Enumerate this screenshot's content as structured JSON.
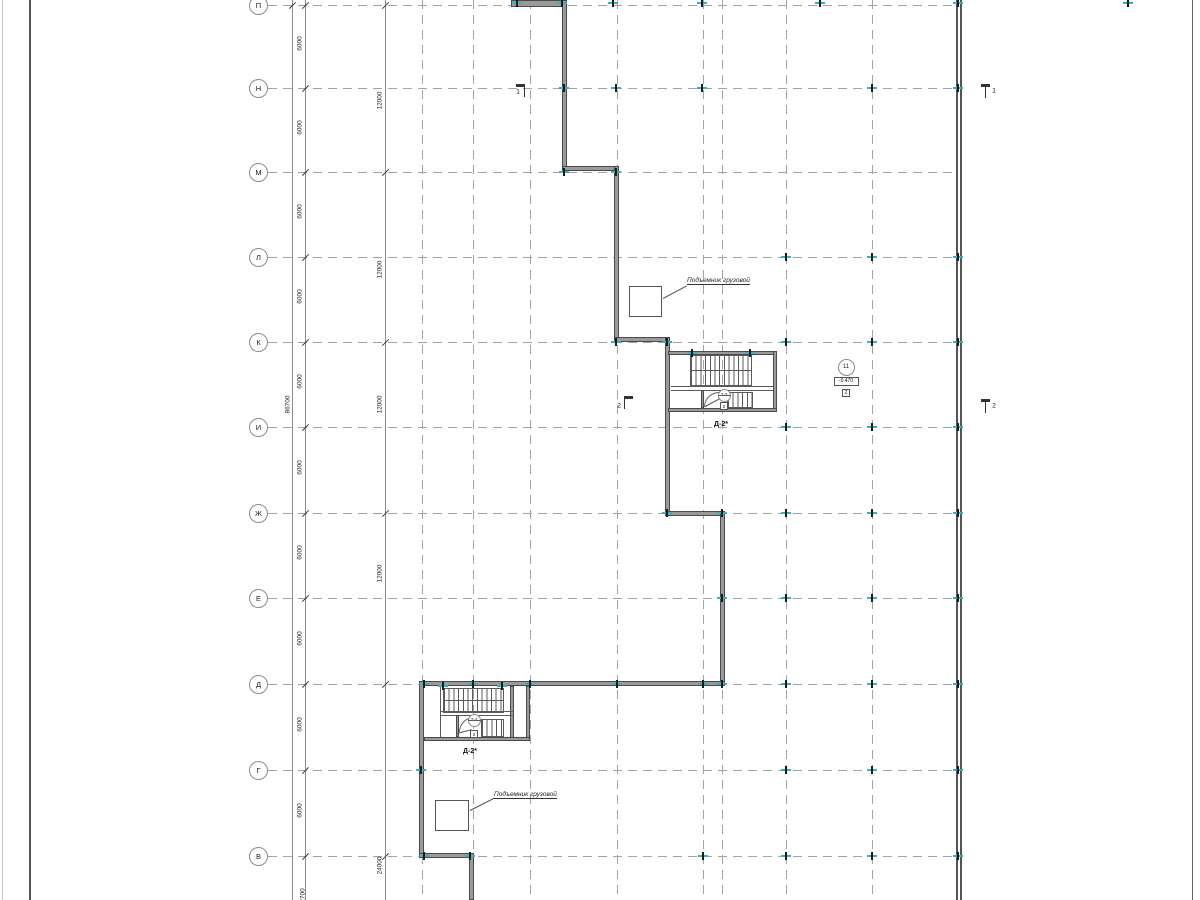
{
  "colors": {
    "accent_teal": "#2fb5bd",
    "wall_fill": "#9a9a9a",
    "wall_edge": "#4b4b4b",
    "grid_gray": "#a3a3a3",
    "chain_gray": "#8c8c8c"
  },
  "frame": {
    "lines": [
      {
        "x": 2,
        "w": 1,
        "color": "#c9c9c9"
      },
      {
        "x": 29,
        "w": 2,
        "color": "#555555"
      },
      {
        "x": 1192,
        "w": 1,
        "color": "#666666"
      }
    ],
    "boundary_double": [
      956,
      960
    ]
  },
  "axis_rows": [
    {
      "label": "П",
      "y": 5
    },
    {
      "label": "Н",
      "y": 88
    },
    {
      "label": "М",
      "y": 172
    },
    {
      "label": "Л",
      "y": 257
    },
    {
      "label": "К",
      "y": 342
    },
    {
      "label": "И",
      "y": 427
    },
    {
      "label": "Ж",
      "y": 513
    },
    {
      "label": "Е",
      "y": 598
    },
    {
      "label": "Д",
      "y": 684
    },
    {
      "label": "Г",
      "y": 770
    },
    {
      "label": "В",
      "y": 856
    }
  ],
  "row_line": {
    "x1": 268,
    "x2": 958
  },
  "axis_cols_x": [
    422,
    473,
    530,
    617,
    703,
    722,
    786,
    872
  ],
  "chains_x": [
    292,
    305,
    385
  ],
  "dimensions": {
    "total": {
      "text": "86700",
      "x": 288,
      "y": 407
    },
    "bays_x": 300,
    "bays": [
      {
        "text": "6000",
        "y": 46
      },
      {
        "text": "6000",
        "y": 130
      },
      {
        "text": "6000",
        "y": 214
      },
      {
        "text": "6000",
        "y": 299
      },
      {
        "text": "6000",
        "y": 384
      },
      {
        "text": "6000",
        "y": 470
      },
      {
        "text": "6000",
        "y": 555
      },
      {
        "text": "6000",
        "y": 641
      },
      {
        "text": "6000",
        "y": 727
      },
      {
        "text": "6000",
        "y": 813
      }
    ],
    "outer_x": 380,
    "outer": [
      {
        "text": "12000",
        "y": 103
      },
      {
        "text": "12000",
        "y": 272
      },
      {
        "text": "12000",
        "y": 407
      },
      {
        "text": "12000",
        "y": 576
      },
      {
        "text": "24000",
        "y": 868
      }
    ],
    "partial_bottom": {
      "text": "2700",
      "x": 303,
      "y": 898
    },
    "ticks": [
      {
        "x": 292,
        "ys": [
          5
        ]
      },
      {
        "x": 305,
        "ys": [
          5,
          88,
          172,
          257,
          342,
          427,
          513,
          598,
          684,
          770,
          856
        ]
      },
      {
        "x": 385,
        "ys": [
          5,
          172,
          342,
          513,
          684,
          856
        ]
      }
    ]
  },
  "walls": [
    [
      511,
      0,
      56,
      7
    ],
    [
      562,
      0,
      5,
      171
    ],
    [
      562,
      166,
      57,
      5
    ],
    [
      614,
      166,
      5,
      176
    ],
    [
      614,
      337,
      56,
      5
    ],
    [
      665,
      337,
      5,
      179
    ],
    [
      665,
      511,
      60,
      5
    ],
    [
      720,
      511,
      5,
      175
    ],
    [
      419,
      681,
      306,
      5
    ],
    [
      419,
      681,
      5,
      177
    ],
    [
      419,
      853,
      55,
      5
    ],
    [
      469,
      853,
      5,
      47
    ],
    [
      668,
      351,
      109,
      4
    ],
    [
      773,
      351,
      4,
      61
    ],
    [
      668,
      408,
      109,
      4
    ],
    [
      510,
      686,
      4,
      55
    ],
    [
      526,
      686,
      4,
      55
    ],
    [
      424,
      737,
      106,
      4
    ]
  ],
  "stairs": [
    {
      "tag": "Д-2*",
      "room": "7-3",
      "door_tag": "2",
      "treads1": [
        690,
        355,
        62,
        31
      ],
      "mid1": [
        690,
        370,
        62,
        1
      ],
      "landing": [
        [
          671,
          386,
          102,
          1
        ],
        [
          671,
          390,
          102,
          1
        ]
      ],
      "treads2": [
        727,
        392,
        26,
        16
      ],
      "inner_wall": [
        701,
        390,
        3,
        18
      ],
      "arc": [
        704,
        392,
        15,
        15
      ],
      "leader": {
        "x": 705,
        "y": 406,
        "len": 17,
        "ang": -28
      },
      "circle": {
        "x": 724,
        "y": 395
      },
      "box": {
        "x": 724,
        "y": 406
      },
      "label": {
        "x": 721,
        "y": 421
      }
    },
    {
      "tag": "Д-2*",
      "room": "7-4",
      "door_tag": "2",
      "treads1": [
        443,
        688,
        61,
        25
      ],
      "mid1": [
        443,
        700,
        61,
        1
      ],
      "landing": [
        [
          441,
          711,
          73,
          1
        ],
        [
          441,
          715,
          73,
          1
        ]
      ],
      "treads2": [
        481,
        719,
        23,
        18
      ],
      "inner_wall": [
        456,
        715,
        3,
        22
      ],
      "arc": [
        459,
        717,
        15,
        15
      ],
      "leader": {
        "x": 457,
        "y": 733,
        "len": 15,
        "ang": -15
      },
      "circle": {
        "x": 474,
        "y": 720
      },
      "box": {
        "x": 474,
        "y": 734
      },
      "label": {
        "x": 470,
        "y": 748
      },
      "extra_line": [
        440,
        686,
        1,
        51
      ]
    }
  ],
  "lifts": [
    {
      "label": "Подъемник грузовой",
      "square": [
        629,
        286,
        33,
        31
      ],
      "leader": {
        "x": 663,
        "y": 298,
        "len": 27,
        "ang": -28
      },
      "label_pos": {
        "x": 687,
        "y": 277
      }
    },
    {
      "label": "Подъемник грузовой",
      "square": [
        435,
        800,
        34,
        31
      ],
      "leader": {
        "x": 470,
        "y": 810,
        "len": 27,
        "ang": -27
      },
      "label_pos": {
        "x": 494,
        "y": 791
      }
    }
  ],
  "callout": {
    "circle_text": "11",
    "circle": {
      "x": 846,
      "y": 367
    },
    "level_text": "-0.470",
    "level": {
      "x": 846,
      "y": 381
    },
    "box_text": "2",
    "box": {
      "x": 846,
      "y": 393
    }
  },
  "sections": [
    {
      "label": "1",
      "bar": [
        516,
        84,
        9,
        3
      ],
      "stem": [
        524,
        84,
        1,
        13
      ],
      "lx": 518,
      "ly": 92
    },
    {
      "label": "1",
      "bar": [
        981,
        84,
        9,
        3
      ],
      "stem": [
        985,
        84,
        1,
        14
      ],
      "lx": 994,
      "ly": 91
    },
    {
      "label": "2",
      "bar": [
        624,
        396,
        9,
        3
      ],
      "stem": [
        624,
        396,
        1,
        13
      ],
      "lx": 619,
      "ly": 406
    },
    {
      "label": "2",
      "bar": [
        981,
        399,
        9,
        3
      ],
      "stem": [
        985,
        399,
        1,
        14
      ],
      "lx": 994,
      "ly": 406
    }
  ],
  "column_markers": [
    [
      517,
      3
    ],
    [
      562,
      3
    ],
    [
      613,
      3
    ],
    [
      702,
      3
    ],
    [
      820,
      3
    ],
    [
      958,
      3
    ],
    [
      1128,
      3
    ],
    [
      564,
      88
    ],
    [
      616,
      88
    ],
    [
      702,
      88
    ],
    [
      872,
      88
    ],
    [
      958,
      88
    ],
    [
      564,
      172
    ],
    [
      616,
      172
    ],
    [
      786,
      257
    ],
    [
      872,
      257
    ],
    [
      958,
      257
    ],
    [
      616,
      342
    ],
    [
      667,
      342
    ],
    [
      786,
      342
    ],
    [
      872,
      342
    ],
    [
      958,
      342
    ],
    [
      786,
      427
    ],
    [
      872,
      427
    ],
    [
      958,
      427
    ],
    [
      667,
      513
    ],
    [
      722,
      513
    ],
    [
      786,
      513
    ],
    [
      872,
      513
    ],
    [
      958,
      513
    ],
    [
      722,
      598
    ],
    [
      786,
      598
    ],
    [
      872,
      598
    ],
    [
      958,
      598
    ],
    [
      424,
      684
    ],
    [
      473,
      684
    ],
    [
      530,
      684
    ],
    [
      617,
      684
    ],
    [
      703,
      684
    ],
    [
      722,
      684
    ],
    [
      786,
      684
    ],
    [
      872,
      684
    ],
    [
      958,
      684
    ],
    [
      421,
      770
    ],
    [
      786,
      770
    ],
    [
      872,
      770
    ],
    [
      958,
      770
    ],
    [
      424,
      856
    ],
    [
      470,
      856
    ],
    [
      703,
      856
    ],
    [
      786,
      856
    ],
    [
      872,
      856
    ],
    [
      958,
      856
    ],
    [
      692,
      353
    ],
    [
      750,
      353
    ],
    [
      443,
      686
    ],
    [
      502,
      686
    ]
  ]
}
